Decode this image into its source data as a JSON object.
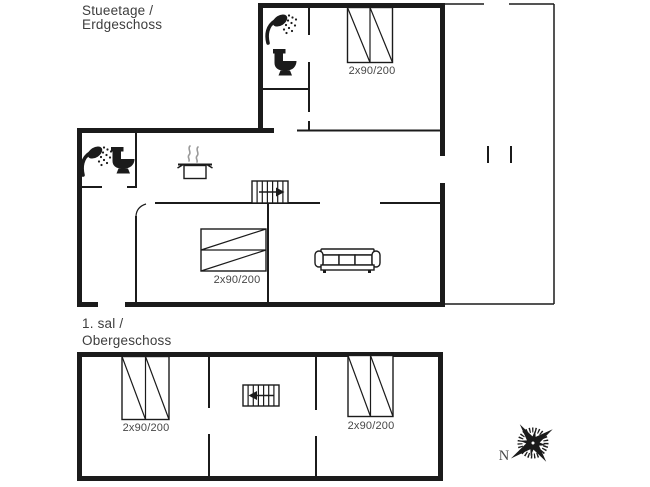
{
  "colors": {
    "line": "#1b1b1b",
    "text": "#3d3d3d",
    "steam": "#9a9a9a",
    "background": "#ffffff"
  },
  "ground_floor": {
    "title_line1": "Stueetage /",
    "title_line2": "Erdgeschoss",
    "beds": [
      {
        "label": "2x90/200"
      },
      {
        "label": "2x90/200"
      }
    ]
  },
  "upper_floor": {
    "title_line1": "1. sal /",
    "title_line2": "Obergeschoss",
    "beds": [
      {
        "label": "2x90/200"
      },
      {
        "label": "2x90/200"
      }
    ]
  },
  "compass": {
    "north_label": "N"
  },
  "icon_names": [
    "shower-icon",
    "toilet-icon",
    "stove-pot-icon",
    "stairs-icon",
    "double-bed-icon",
    "sofa-icon",
    "compass-rose-icon"
  ]
}
